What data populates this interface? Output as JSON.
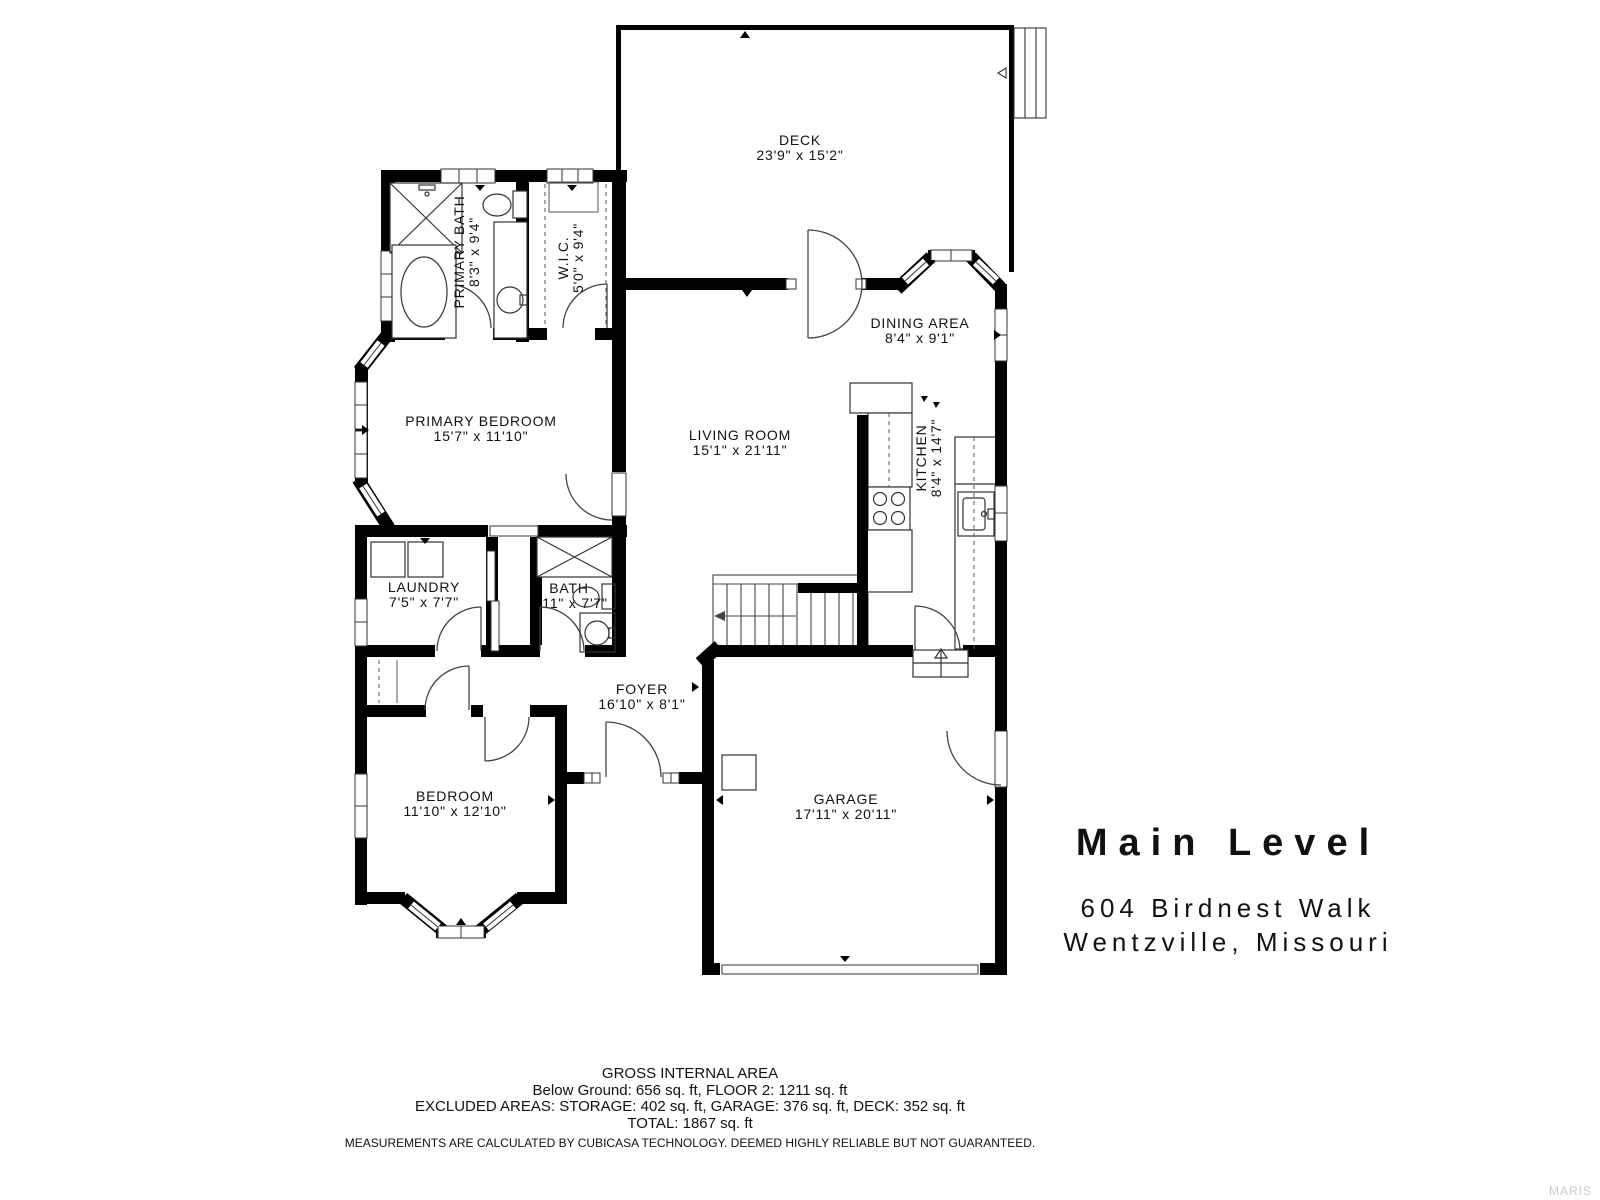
{
  "floor_plan": {
    "title": "Main Level",
    "address_line1": "604 Birdnest Walk",
    "address_line2": "Wentzville, Missouri",
    "rooms": [
      {
        "name": "DECK",
        "dims": "23'9\" x 15'2\""
      },
      {
        "name": "PRIMARY BATH",
        "dims": "8'3\" x 9'4\""
      },
      {
        "name": "W.I.C.",
        "dims": "5'0\" x 9'4\""
      },
      {
        "name": "DINING AREA",
        "dims": "8'4\" x 9'1\""
      },
      {
        "name": "PRIMARY BEDROOM",
        "dims": "15'7\" x 11'10\""
      },
      {
        "name": "LIVING ROOM",
        "dims": "15'1\" x 21'11\""
      },
      {
        "name": "KITCHEN",
        "dims": "8'4\" x 14'7\""
      },
      {
        "name": "LAUNDRY",
        "dims": "7'5\" x 7'7\""
      },
      {
        "name": "BATH",
        "dims": "4'11\" x 7'7\""
      },
      {
        "name": "FOYER",
        "dims": "16'10\" x 8'1\""
      },
      {
        "name": "BEDROOM",
        "dims": "11'10\" x 12'10\""
      },
      {
        "name": "GARAGE",
        "dims": "17'11\" x 20'11\""
      }
    ],
    "footer": {
      "line1": "GROSS INTERNAL AREA",
      "line2": "Below Ground: 656 sq. ft, FLOOR 2: 1211 sq. ft",
      "line3": "EXCLUDED AREAS: STORAGE: 402 sq. ft, GARAGE: 376 sq. ft, DECK: 352 sq. ft",
      "line4": "TOTAL: 1867 sq. ft",
      "disclaimer": "MEASUREMENTS ARE CALCULATED BY CUBICASA TECHNOLOGY. DEEMED HIGHLY RELIABLE BUT NOT GUARANTEED."
    },
    "watermark": "MARIS"
  }
}
